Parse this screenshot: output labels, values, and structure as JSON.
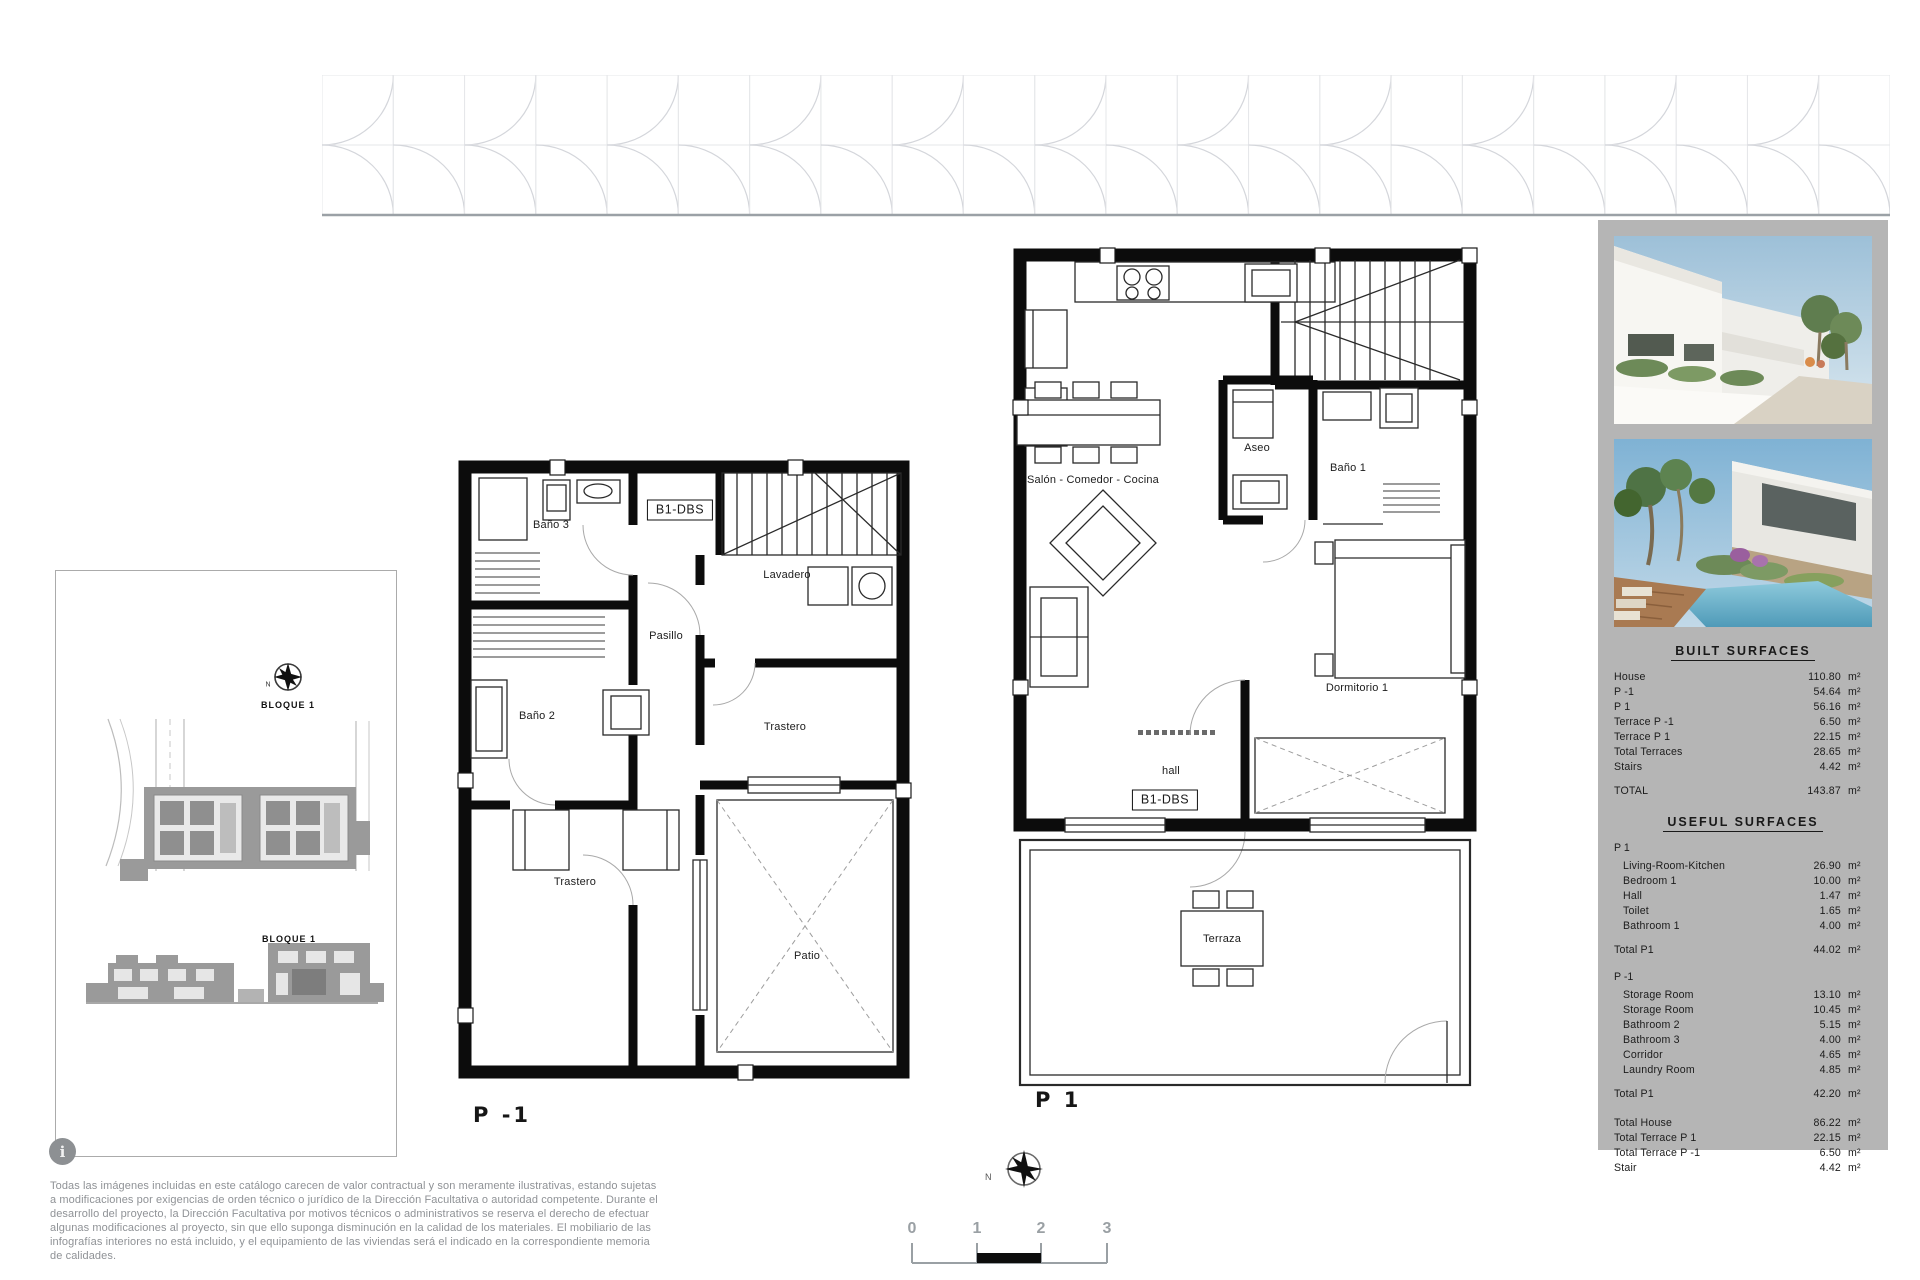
{
  "unit": "m²",
  "site": {
    "bloque_top": "BLOQUE 1",
    "bloque_bottom": "BLOQUE 1",
    "north": "N"
  },
  "plan_p_minus1": {
    "title": "P -1",
    "tag": "B1-DBS",
    "room_bano3": "Baño 3",
    "room_pasillo": "Pasillo",
    "room_lavadero": "Lavadero",
    "room_bano2": "Baño 2",
    "room_trastero_a": "Trastero",
    "room_trastero_b": "Trastero",
    "room_patio": "Patio"
  },
  "plan_p1": {
    "title": "P 1",
    "tag": "B1-DBS",
    "room_salon": "Salón - Comedor - Cocina",
    "room_aseo": "Aseo",
    "room_bano1": "Baño 1",
    "room_dormitorio": "Dormitorio 1",
    "room_hall": "hall",
    "room_terraza": "Terraza"
  },
  "panel": {
    "built_title": "BUILT SURFACES",
    "built_rows": [
      [
        "House",
        "110.80"
      ],
      [
        "P -1",
        "54.64"
      ],
      [
        "P 1",
        "56.16"
      ],
      [
        "Terrace  P -1",
        "6.50"
      ],
      [
        "Terrace  P 1",
        "22.15"
      ],
      [
        "Total Terraces",
        "28.65"
      ],
      [
        "Stairs",
        "4.42"
      ]
    ],
    "built_total": [
      "TOTAL",
      "143.87"
    ],
    "useful_title": "USEFUL SURFACES",
    "useful_sections": [
      {
        "header": "P 1",
        "rows": [
          [
            "Living-Room-Kitchen",
            "26.90"
          ],
          [
            "Bedroom 1",
            "10.00"
          ],
          [
            "Hall",
            "1.47"
          ],
          [
            "Toilet",
            "1.65"
          ],
          [
            "Bathroom 1",
            "4.00"
          ]
        ],
        "total": [
          "Total P1",
          "44.02"
        ]
      },
      {
        "header": "P -1",
        "rows": [
          [
            "Storage Room",
            "13.10"
          ],
          [
            "Storage Room",
            "10.45"
          ],
          [
            "Bathroom 2",
            "5.15"
          ],
          [
            "Bathroom 3",
            "4.00"
          ],
          [
            "Corridor",
            "4.65"
          ],
          [
            "Laundry Room",
            "4.85"
          ]
        ],
        "total": [
          "Total P1",
          "42.20"
        ]
      }
    ],
    "summary_rows": [
      [
        "Total House",
        "86.22"
      ],
      [
        "Total Terrace  P 1",
        "22.15"
      ],
      [
        "Total Terrace  P -1",
        "6.50"
      ],
      [
        "Stair",
        "4.42"
      ]
    ]
  },
  "footer": {
    "info_glyph": "i",
    "disclaimer": "Todas las imágenes incluidas en este catálogo carecen de valor contractual y son meramente ilustrativas, estando sujetas a modificaciones por exigencias de orden técnico o jurídico de la Dirección Facultativa o autoridad competente. Durante el desarrollo del proyecto, la Dirección Facultativa por motivos técnicos o administrativos se reserva el derecho de efectuar algunas modificaciones al proyecto, sin que ello suponga disminución en la calidad de los materiales. El mobiliario de las infografías interiores no está incluido, y el equipamiento de las viviendas será el indicado en la correspondiente memoria de calidades.",
    "north": "N",
    "scale_labels": [
      "0",
      "1",
      "2",
      "3"
    ]
  }
}
